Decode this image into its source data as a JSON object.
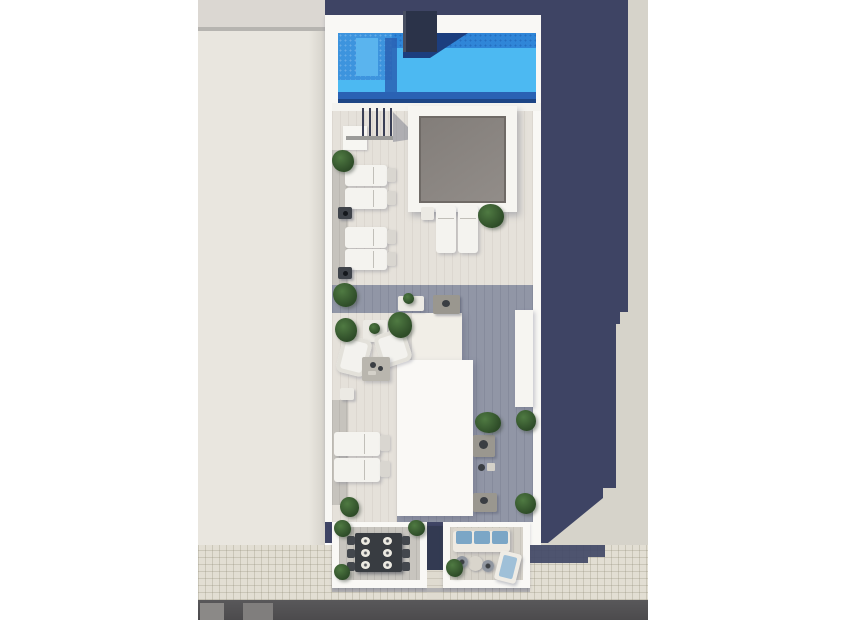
{
  "scene": {
    "type": "architectural-render",
    "description": "Top-down 3D render of a narrow rooftop terrace building with swimming pool, skylight, sun loungers and two street-level terraces; neighboring flat roof on the left, long cast shadow to the right, tiled sidewalk and asphalt road at the bottom.",
    "objects": {
      "swimming_pool": 1,
      "pool_chimney_block": 1,
      "skylight": 1,
      "stair_railing_posts": 5,
      "sun_loungers_left_column": 4,
      "sun_loungers_center": 2,
      "sun_loungers_lower": 2,
      "terrace_lounger": 1,
      "armchairs": 2,
      "coffee_tables": 2,
      "side_tables_dark": 2,
      "side_tables_small": 4,
      "outdoor_kitchen_counters": 3,
      "dining_table": 1,
      "dining_plates": 6,
      "dining_chairs": 6,
      "sofa": 1,
      "sofa_cushions": 3,
      "bistro_table": 1,
      "bistro_chairs": 2,
      "plants": 15
    },
    "palette": {
      "canvas": "#ffffff",
      "roof-top": "#dbd7d2",
      "roof-edge": "#b6b4b0",
      "roof": "#e9e6df",
      "ground-sunlit": "#d6d3ca",
      "cast-shadow": "#3e4464",
      "sidewalk": "#e2ded3",
      "road": "#59585a",
      "road-patch-a": "#8b8987",
      "road-patch-b": "#807e7d",
      "building": "#f9f8f5",
      "deck": "#e5e1da",
      "deck-shadow": "#9196a6",
      "left-strip": "#c6c3bd",
      "pool-water": "#4cb9f2",
      "pool-shade": "#2f86d8",
      "pool-bench": "#3d94de",
      "pool-bench-light": "#5ab4ee",
      "pool-dark": "#2a62b4",
      "pool-deep": "#1d4585",
      "pool-wedge": "#1c3e7e",
      "chimney": "#2b3349",
      "skylight": "#8d8884",
      "skylight-frame": "#f6f5f1",
      "furniture-white": "#f4f3ef",
      "furniture-flap": "#d9d6d0",
      "table-dark": "#3f434a",
      "table-gray": "#9a978f",
      "coffee-table": "#b9b6ae",
      "plant-dark": "#2e4c28",
      "plant-light": "#4f7a42",
      "terrace-floor-left": "#c8c5bf",
      "terrace-floor-right": "#d6d2c9",
      "dining-table": "#383c41",
      "sofa-base": "#eeeae2",
      "sofa-cushion": "#7ba6c6",
      "lounger-cushion": "#9fc0d8",
      "passage-dark": "#333a52",
      "path": "#dfdbd0",
      "block-cream": "#f1eee7",
      "block-white": "#faf9f6"
    }
  }
}
